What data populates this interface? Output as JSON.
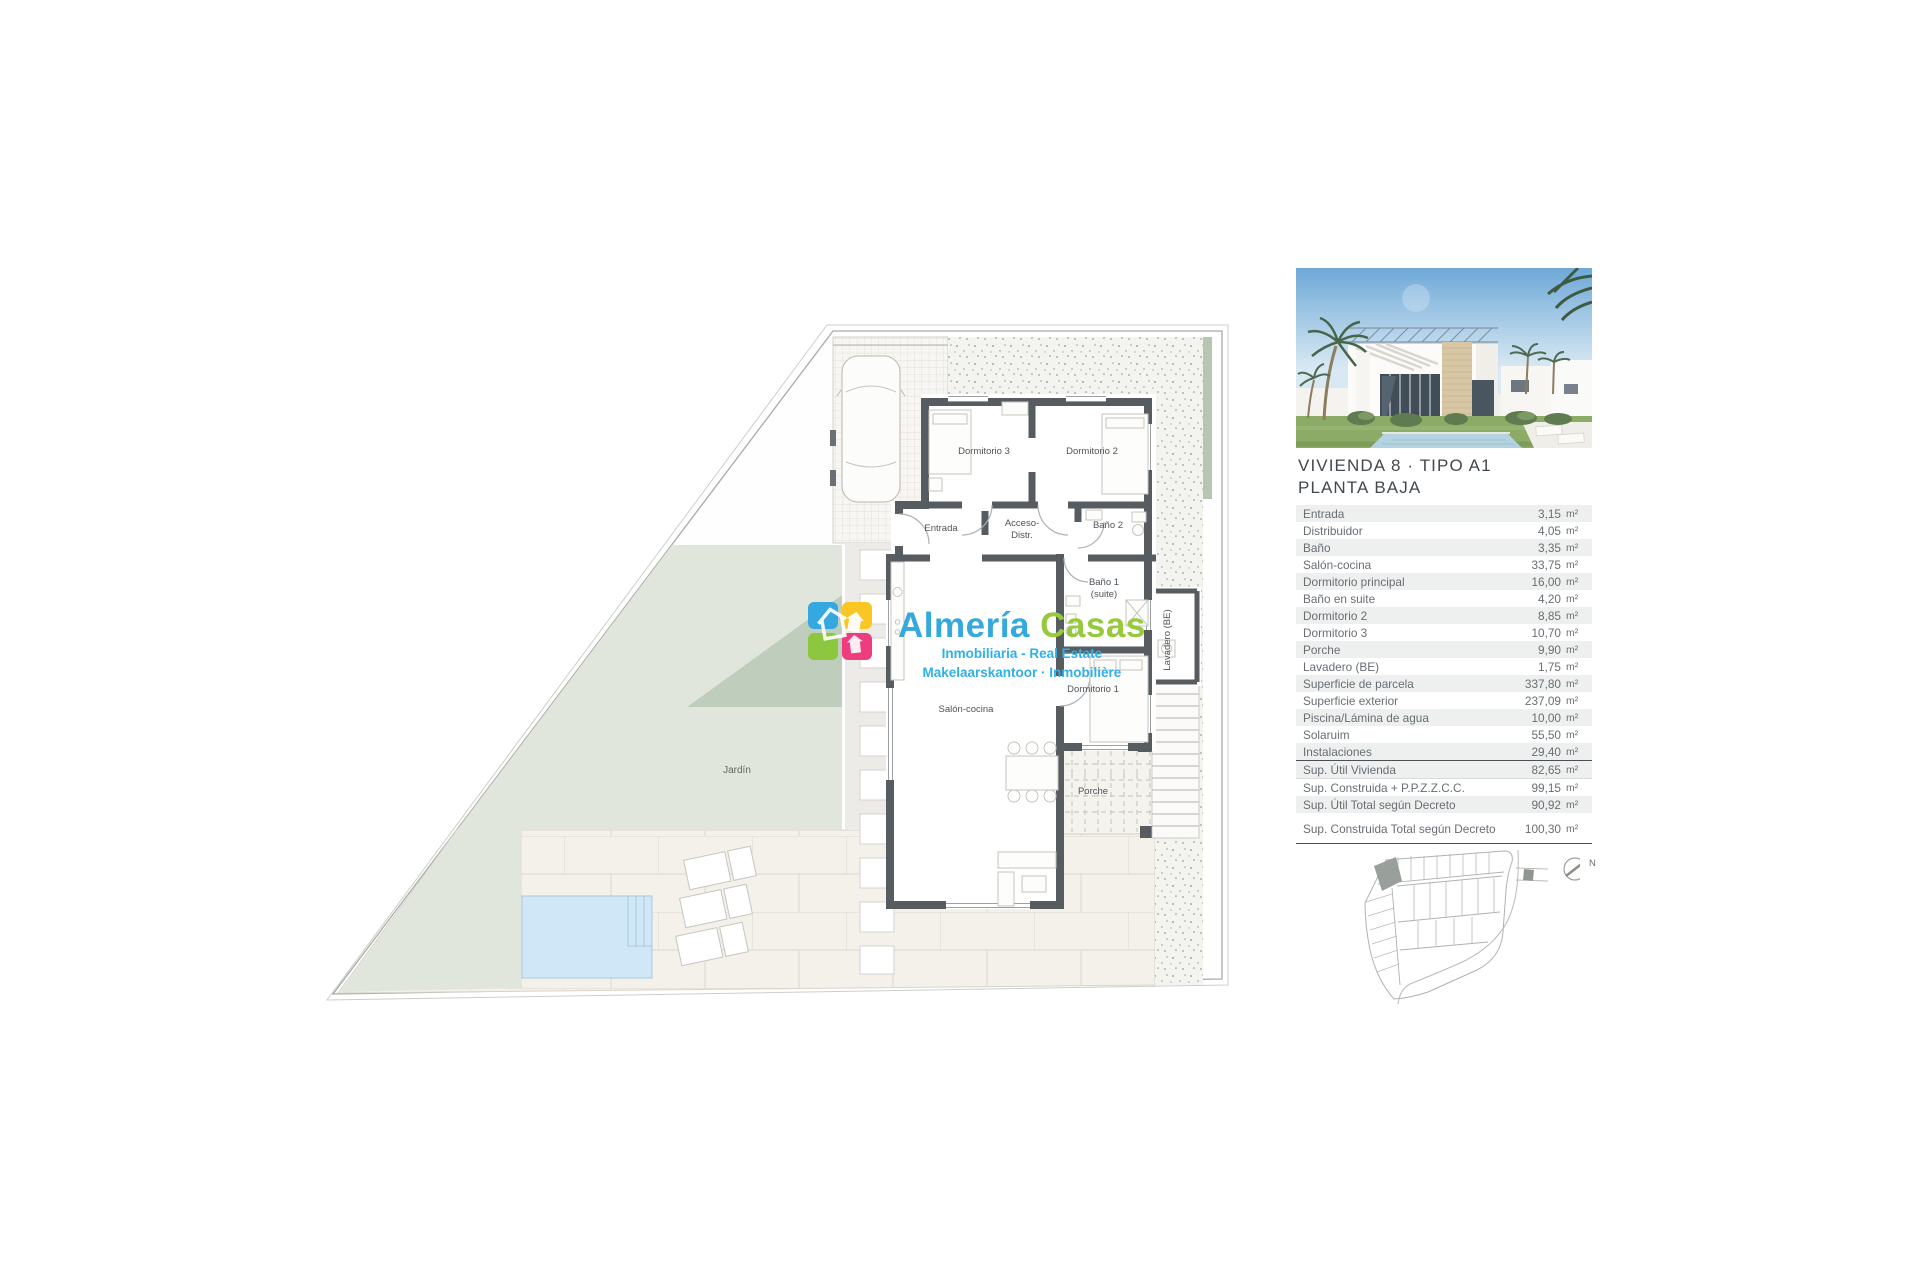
{
  "watermark": {
    "name_first": "Almería",
    "name_second": "Casas",
    "tagline1": "Inmobiliaria - Real Estate",
    "tagline2": "Makelaarskantoor · Inmobilière"
  },
  "plan": {
    "labels": {
      "dormitorio3": "Dormitorio 3",
      "dormitorio2": "Dormitorio 2",
      "dormitorio1": "Dormitorio 1",
      "entrada": "Entrada",
      "acceso_line1": "Acceso-",
      "acceso_line2": "Distr.",
      "bano2": "Baño 2",
      "bano1_line1": "Baño 1",
      "bano1_line2": "(suite)",
      "salon": "Salón-cocina",
      "lavadero": "Lavadero (BE)",
      "porche": "Porche",
      "jardin": "Jardín"
    },
    "compass": "N"
  },
  "panel": {
    "title_line1": "VIVIENDA 8 · TIPO A1",
    "title_line2": "PLANTA BAJA",
    "unit": "m²",
    "rows": [
      {
        "label": "Entrada",
        "value": "3,15"
      },
      {
        "label": "Distribuidor",
        "value": "4,05"
      },
      {
        "label": "Baño",
        "value": "3,35"
      },
      {
        "label": "Salón-cocina",
        "value": "33,75"
      },
      {
        "label": "Dormitorio principal",
        "value": "16,00"
      },
      {
        "label": "Baño en suite",
        "value": "4,20"
      },
      {
        "label": "Dormitorio 2",
        "value": "8,85"
      },
      {
        "label": "Dormitorio 3",
        "value": "10,70"
      },
      {
        "label": "Porche",
        "value": "9,90"
      },
      {
        "label": "Lavadero (BE)",
        "value": "1,75"
      },
      {
        "label": "Superficie de parcela",
        "value": "337,80"
      },
      {
        "label": "Superficie exterior",
        "value": "237,09"
      },
      {
        "label": "Piscina/Lámina de agua",
        "value": "10,00"
      },
      {
        "label": "Solaruim",
        "value": "55,50"
      },
      {
        "label": "Instalaciones",
        "value": "29,40"
      }
    ],
    "summary1": {
      "label": "Sup. Útil Vivienda",
      "value": "82,65"
    },
    "summary2": {
      "label": "Sup. Construida + P.P.Z.Z.C.C.",
      "value": "99,15"
    },
    "summary3": {
      "label": "Sup. Útil Total según Decreto",
      "value": "90,92"
    },
    "summary4": {
      "label": "Sup. Construida Total según Decreto",
      "value": "100,30"
    }
  },
  "colors": {
    "wall": "#575c60",
    "pool": "#cfe7f6",
    "sage": "#e0e6dc",
    "sage_dark": "#bfcdbc",
    "logo_blue": "#35a8e0",
    "logo_yellow": "#f9c623",
    "logo_green": "#8dc63f",
    "logo_pink": "#ee3d7f"
  }
}
